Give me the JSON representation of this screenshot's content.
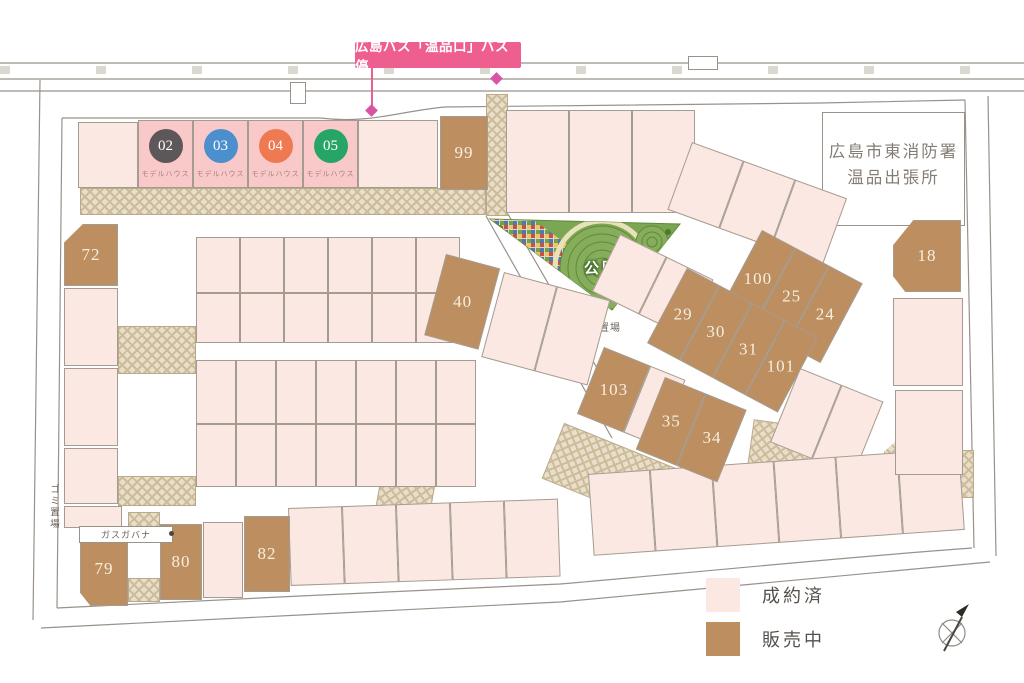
{
  "labels": {
    "bus_stop": "広島バス「温品口」バス停",
    "fire_station_line1": "広島市東消防署",
    "fire_station_line2": "温品出張所",
    "park": "公園",
    "garbage": "ゴミ置場",
    "garbage_vertical": "ゴミ置場",
    "gas_governor": "ガスガバナ"
  },
  "model_houses": [
    {
      "number": "02",
      "label": "モデルハウス",
      "badge_color": "#5d575a"
    },
    {
      "number": "03",
      "label": "モデルハウス",
      "badge_color": "#4b8fcc"
    },
    {
      "number": "04",
      "label": "モデルハウス",
      "badge_color": "#ef7a52"
    },
    {
      "number": "05",
      "label": "モデルハウス",
      "badge_color": "#26a566"
    }
  ],
  "lots_for_sale": {
    "lot99": "99",
    "lot72": "72",
    "lot18": "18",
    "lot100": "100",
    "lot25": "25",
    "lot24": "24",
    "lot29": "29",
    "lot30": "30",
    "lot31": "31",
    "lot101": "101",
    "lot40": "40",
    "lot103": "103",
    "lot35": "35",
    "lot34": "34",
    "lot79": "79",
    "lot80": "80",
    "lot82": "82"
  },
  "legend": {
    "items": [
      {
        "label": "成約済",
        "color": "#fbe8e2"
      },
      {
        "label": "販売中",
        "color": "#bc8e60"
      }
    ]
  },
  "colors": {
    "sold_lot": "#fbe8e2",
    "for_sale_lot": "#bc8e60",
    "model_house_lot": "#f8c9c8",
    "bus_label_bg": "#ee5f8f",
    "park_green": "#7ca653",
    "paving": "#e8decb",
    "road_line": "#9a9189"
  }
}
